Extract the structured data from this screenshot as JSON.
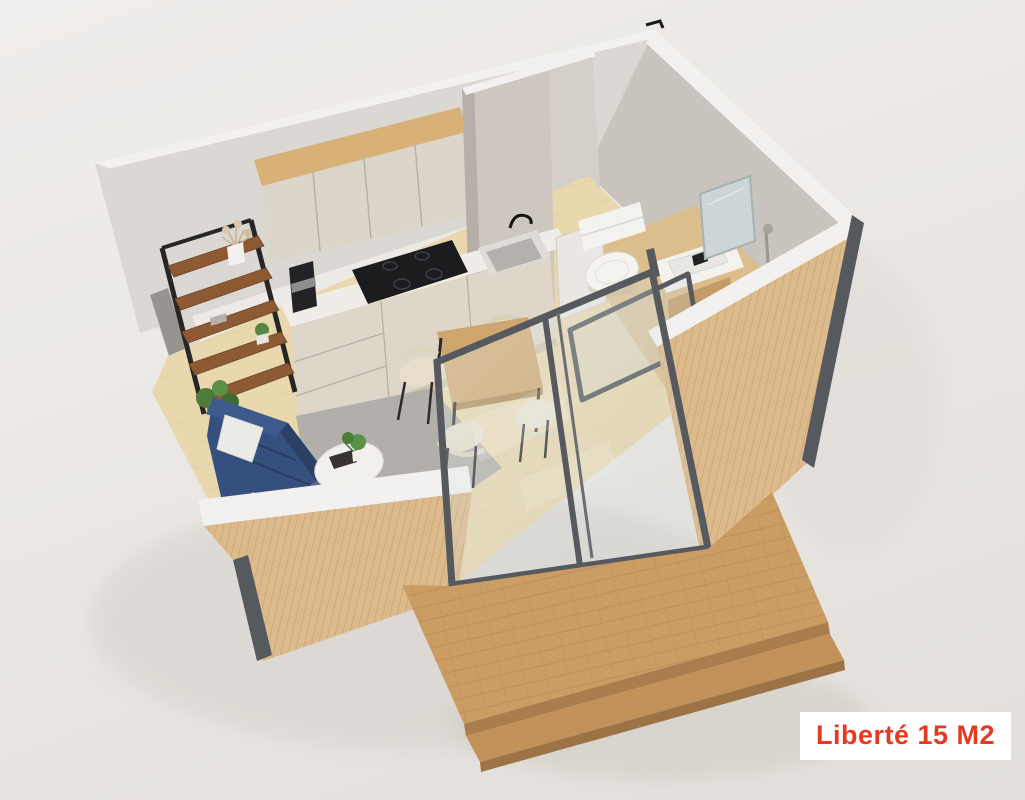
{
  "label": {
    "text": "Liberté 15 M2"
  },
  "scene": {
    "type": "isometric-3d-floorplan-render",
    "description": "Cutaway aerial 3D render of a 15 square meter tiny house model",
    "rooms": [
      "kitchen",
      "dining-area",
      "living-area",
      "bathroom",
      "terrace-deck"
    ],
    "objects": [
      "upper-kitchen-cabinets",
      "wood-cabinet-frame",
      "base-cabinets-with-drawers",
      "induction-cooktop",
      "kitchen-sink",
      "coffee-machine",
      "ladder-shelf",
      "vase-with-dried-flowers",
      "potted-plants",
      "navy-sofa",
      "white-cushion",
      "gray-throw",
      "gray-rug",
      "round-coffee-table",
      "square-dining-table",
      "dining-chairs",
      "sliding-glass-door",
      "toilet",
      "vanity-sink",
      "mirror",
      "shower",
      "wood-slat-facade",
      "wooden-deck-with-step"
    ]
  },
  "colors": {
    "bg_top": "#f0eeec",
    "bg_mid": "#e9e6e2",
    "bg_bottom": "#e2dfda",
    "wall_white": "#dbd7d2",
    "wall_cap": "#f3f1ef",
    "wall_concrete": "#c9c4be",
    "wall_concrete_light": "#d4cfc9",
    "floor_wood": "#e9d7ae",
    "floor_bath": "#dcbe8c",
    "wood_accent": "#d8b178",
    "cabinet_cream": "#dbd5ca",
    "counter_white": "#f0ede9",
    "wood_slat": "#ddba8b",
    "wood_deck": "#cb9d63",
    "sofa_navy": "#35507e",
    "rug_gray": "#b2afaa",
    "frame_dark": "#565a5e",
    "fixture_white": "#f3f2ef",
    "appliance_black": "#1b1c1e",
    "chair_cream": "#e7dfcc",
    "table_wood": "#cfa76e",
    "shelf_wood": "#8d5a33",
    "plant_green": "#56863f",
    "label_bg": "#ffffff",
    "label_text": "#e53a22"
  }
}
